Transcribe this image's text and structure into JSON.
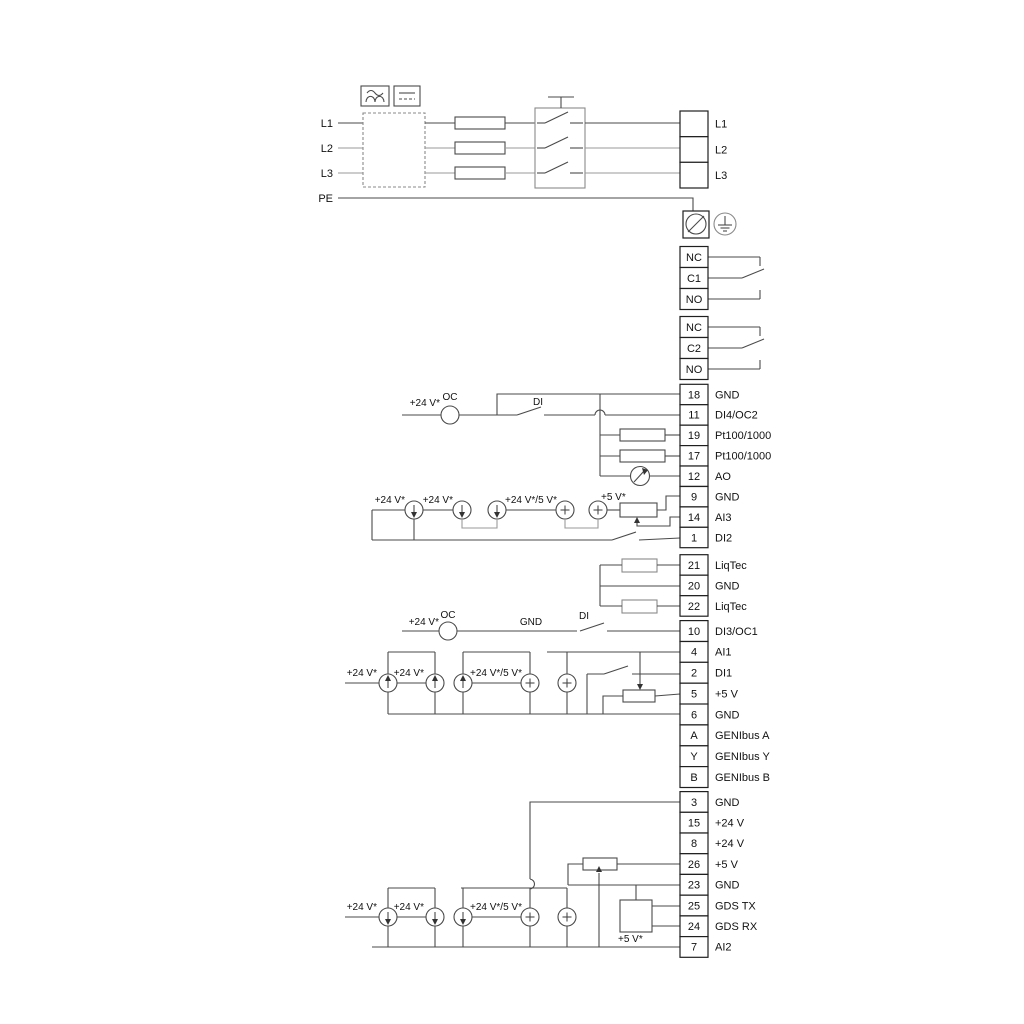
{
  "labels": {
    "l1": "L1",
    "l2": "L2",
    "l3": "L3",
    "pe": "PE",
    "v24": "+24 V*",
    "v24v5": "+24 V*/5 V*",
    "v5": "+5 V*",
    "oc": "OC",
    "di": "DI",
    "gnd": "GND"
  },
  "terminal_groups": [
    {
      "name": "mains-output",
      "cells": [
        {
          "id": "",
          "label": "L1"
        },
        {
          "id": "",
          "label": "L2"
        },
        {
          "id": "",
          "label": "L3"
        }
      ]
    },
    {
      "name": "relay-1",
      "cells": [
        {
          "id": "NC",
          "label": ""
        },
        {
          "id": "C1",
          "label": ""
        },
        {
          "id": "NO",
          "label": ""
        }
      ]
    },
    {
      "name": "relay-2",
      "cells": [
        {
          "id": "NC",
          "label": ""
        },
        {
          "id": "C2",
          "label": ""
        },
        {
          "id": "NO",
          "label": ""
        }
      ]
    },
    {
      "name": "io-group-1",
      "cells": [
        {
          "id": "18",
          "label": "GND"
        },
        {
          "id": "11",
          "label": "DI4/OC2"
        },
        {
          "id": "19",
          "label": "Pt100/1000"
        },
        {
          "id": "17",
          "label": "Pt100/1000"
        },
        {
          "id": "12",
          "label": "AO"
        },
        {
          "id": "9",
          "label": "GND"
        },
        {
          "id": "14",
          "label": "AI3"
        },
        {
          "id": "1",
          "label": "DI2"
        }
      ]
    },
    {
      "name": "liqtec-group",
      "cells": [
        {
          "id": "21",
          "label": "LiqTec"
        },
        {
          "id": "20",
          "label": "GND"
        },
        {
          "id": "22",
          "label": "LiqTec"
        }
      ]
    },
    {
      "name": "io-group-2",
      "cells": [
        {
          "id": "10",
          "label": "DI3/OC1"
        },
        {
          "id": "4",
          "label": "AI1"
        },
        {
          "id": "2",
          "label": "DI1"
        },
        {
          "id": "5",
          "label": "+5 V"
        },
        {
          "id": "6",
          "label": "GND"
        },
        {
          "id": "A",
          "label": "GENIbus A"
        },
        {
          "id": "Y",
          "label": "GENIbus Y"
        },
        {
          "id": "B",
          "label": "GENIbus B"
        }
      ]
    },
    {
      "name": "io-group-3",
      "cells": [
        {
          "id": "3",
          "label": "GND"
        },
        {
          "id": "15",
          "label": "+24 V"
        },
        {
          "id": "8",
          "label": "+24 V"
        },
        {
          "id": "26",
          "label": "+5 V"
        },
        {
          "id": "23",
          "label": "GND"
        },
        {
          "id": "25",
          "label": "GDS TX"
        },
        {
          "id": "24",
          "label": "GDS RX"
        },
        {
          "id": "7",
          "label": "AI2"
        }
      ]
    }
  ]
}
